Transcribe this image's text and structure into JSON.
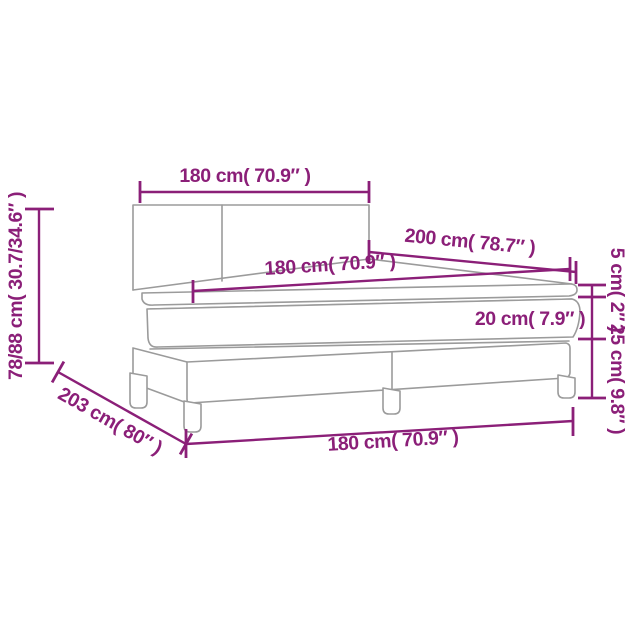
{
  "title": "Box spring bed dimension diagram",
  "colors": {
    "dimension_accent": "#8b1f78",
    "drawing_lines": "#9b9b9b",
    "background": "#ffffff"
  },
  "dims": {
    "headboard_width": {
      "label": "180 cm( 70.9″ )"
    },
    "overall_height": {
      "label": "78/88 cm( 30.7/34.6″ )"
    },
    "bed_length": {
      "label": "200 cm( 78.7″ )"
    },
    "mattress_width": {
      "label": "180 cm( 70.9″ )"
    },
    "topper_thickness": {
      "label": "5 cm( 2″ )"
    },
    "mattress_thickness": {
      "label": "20 cm( 7.9″ )"
    },
    "base_height": {
      "label": "25 cm( 9.8″ )"
    },
    "floor_length": {
      "label": "203 cm( 80″ )"
    },
    "base_width": {
      "label": "180 cm( 70.9″ )"
    }
  }
}
